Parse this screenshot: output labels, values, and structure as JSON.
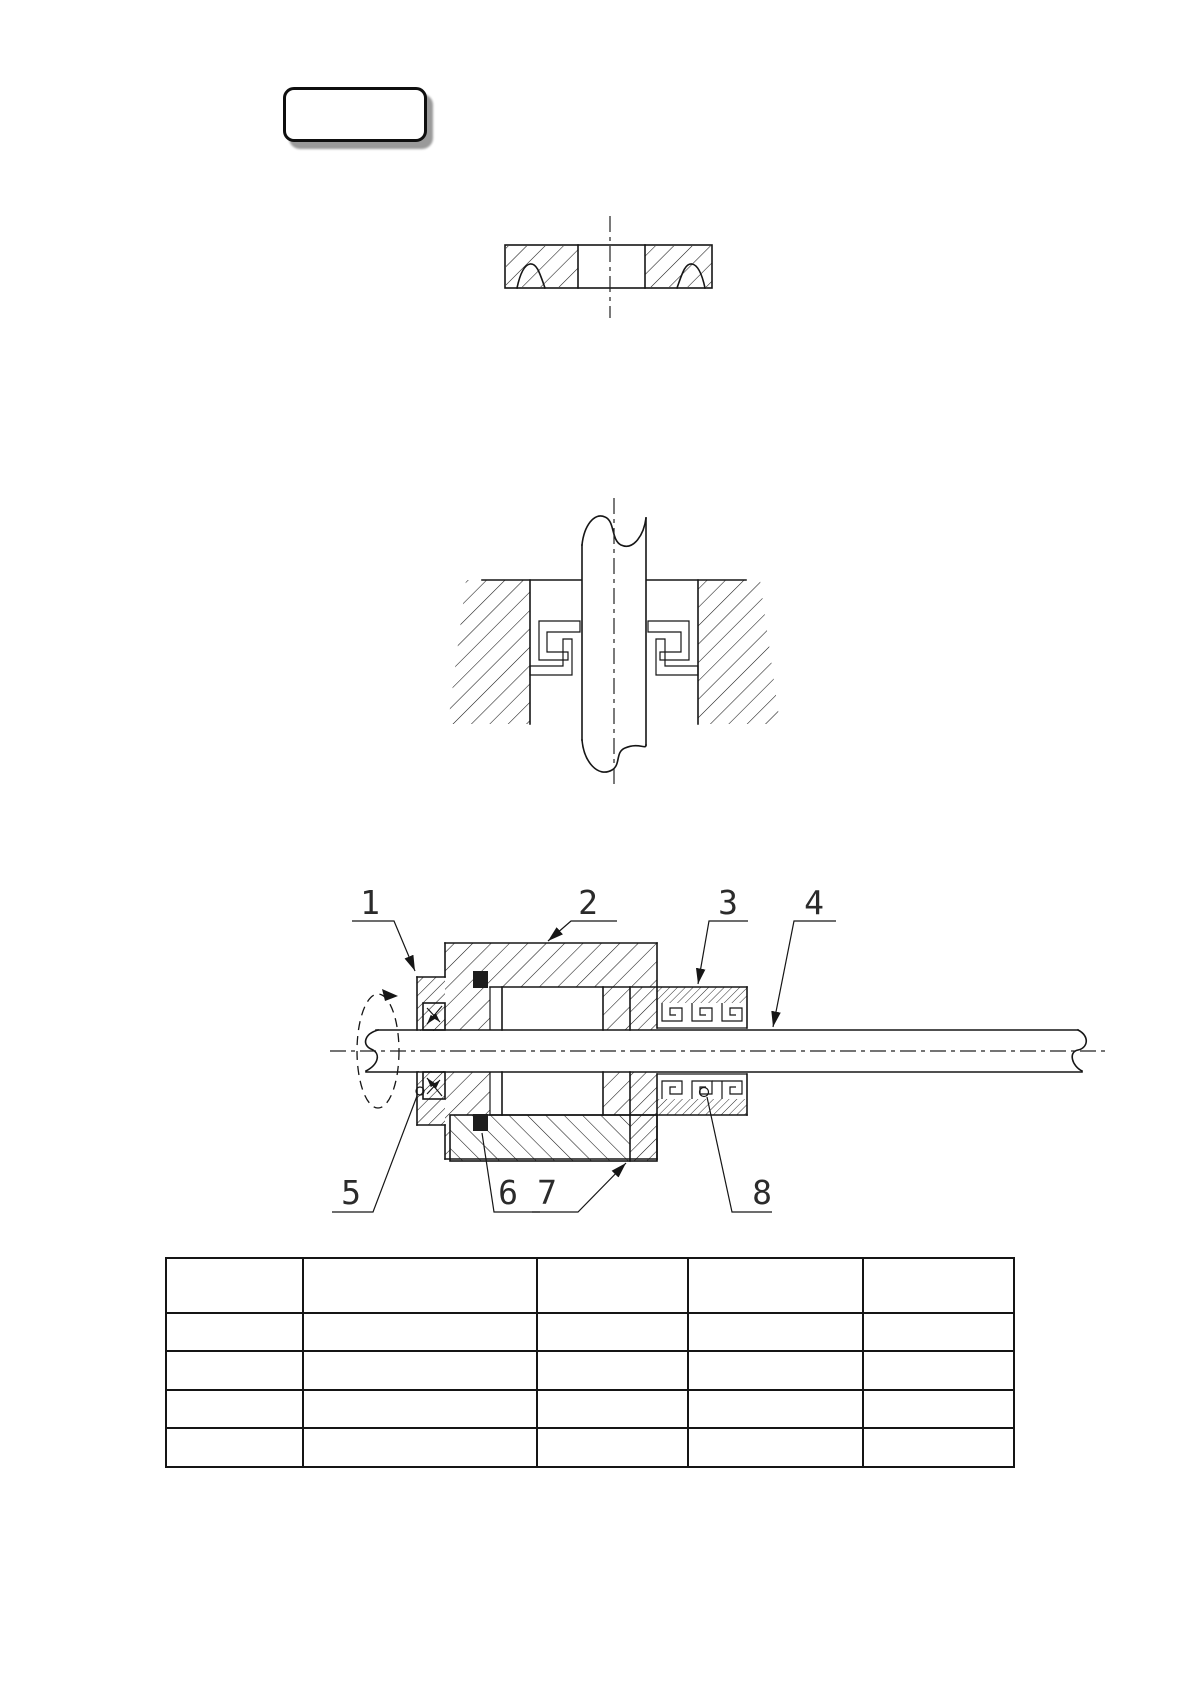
{
  "badge": {
    "label": ""
  },
  "figures": {
    "top": "felt-ring-cross-section",
    "middle": "shaft-seal-housing-section",
    "bottom": "bearing-assembly-with-seals"
  },
  "drawing": {
    "callouts": [
      "1",
      "2",
      "3",
      "4",
      "5",
      "6",
      "7",
      "8"
    ]
  },
  "parts_table": {
    "columns": 5,
    "rows": 5,
    "cells": [
      [
        "",
        "",
        "",
        "",
        ""
      ],
      [
        "",
        "",
        "",
        "",
        ""
      ],
      [
        "",
        "",
        "",
        "",
        ""
      ],
      [
        "",
        "",
        "",
        "",
        ""
      ],
      [
        "",
        "",
        "",
        "",
        ""
      ]
    ]
  }
}
